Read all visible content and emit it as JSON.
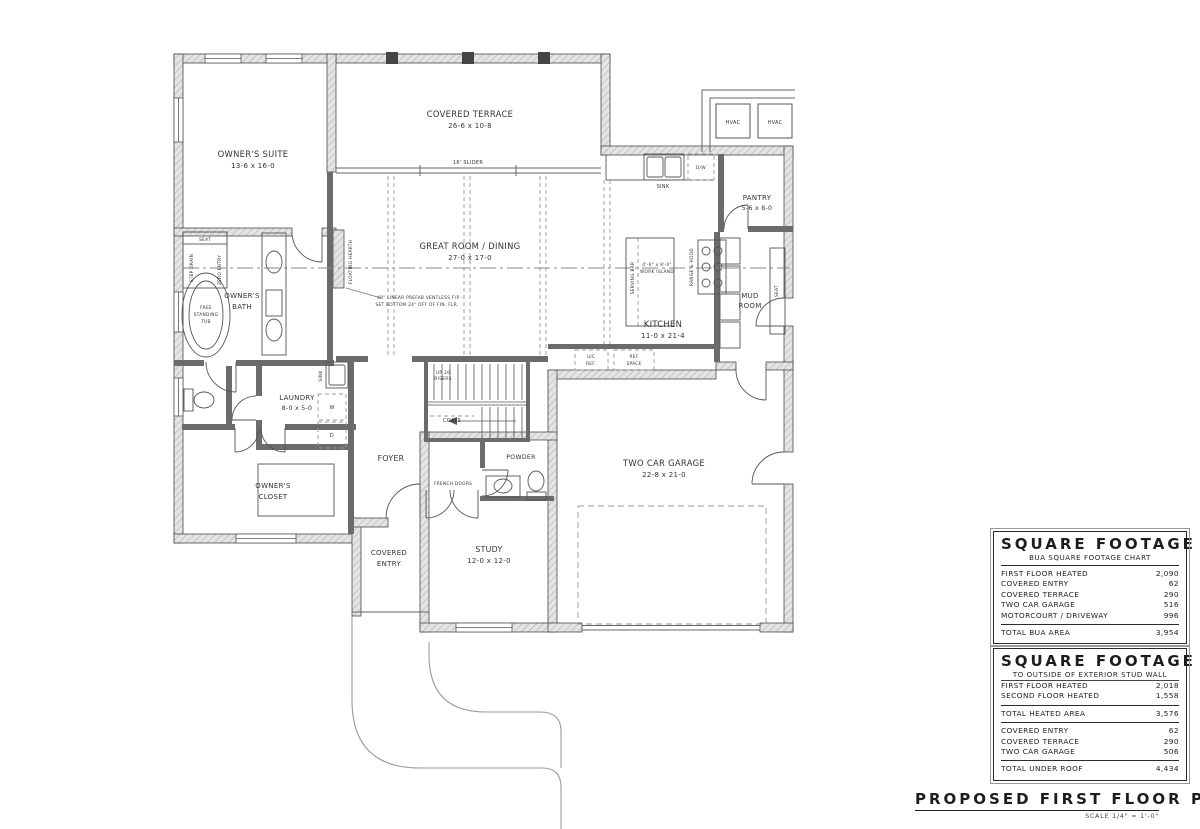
{
  "colors": {
    "ink": "#333333",
    "wall_fill": "#e4e4e4",
    "dashed": "#999999"
  },
  "labels": {
    "owners_suite_name": "OWNER'S SUITE",
    "owners_suite_dims": "13-6 x 16-0",
    "covered_terrace_name": "COVERED TERRACE",
    "covered_terrace_dims": "26-6 x 10-8",
    "slider": "16' SLIDER",
    "great_room_name": "GREAT ROOM / DINING",
    "great_room_dims": "27-0 x 17-0",
    "fp_note_1": "48\" LINEAR PREFAB VENTLESS F/P -",
    "fp_note_2": "SET BOTTOM 24\" OFF OF FIN. FLR.",
    "floating_hearth": "FLOATING HEARTH",
    "kitchen_name": "KITCHEN",
    "kitchen_dims": "11-0 x 21-4",
    "serving_bar": "SERVING BAR",
    "island_dims": "4'-0\" x 9'-0\"",
    "island_name": "WORK ISLAND",
    "range_hood": "RANGE & HOOD",
    "sink_kitchen": "SINK",
    "dw": "D/W",
    "pantry_name": "PANTRY",
    "pantry_dims": "5-6 x 8-0",
    "mud_room_1": "MUD",
    "mud_room_2": "ROOM",
    "seat_mud": "SEAT",
    "owners_bath_1": "OWNER'S",
    "owners_bath_2": "BATH",
    "tub_1": "FREE",
    "tub_2": "STANDING",
    "tub_3": "TUB",
    "seat_shower": "SEAT",
    "step_drain": "STEP DRAIN",
    "zero_entry": "ZERO ENTRY",
    "laundry_name": "LAUNDRY",
    "laundry_dims": "8-0 x 5-0",
    "sink_laundry": "SINK",
    "washer": "W",
    "dryer": "D",
    "foyer": "FOYER",
    "coats": "COATS",
    "up_1": "UP 20",
    "up_2": "RISERS",
    "powder": "POWDER",
    "french_doors": "FRENCH DOORS",
    "study_name": "STUDY",
    "study_dims": "12-0 x 12-0",
    "covered_entry_1": "COVERED",
    "covered_entry_2": "ENTRY",
    "owners_closet_1": "OWNER'S",
    "owners_closet_2": "CLOSET",
    "garage_name": "TWO CAR GARAGE",
    "garage_dims": "22-8 x 21-0",
    "hvac": "HVAC",
    "uc_ref_1": "U/C",
    "uc_ref_2": "REF.",
    "ref_space_1": "REF",
    "ref_space_2": "SPACE"
  },
  "tables": {
    "bua": {
      "title": "SQUARE FOOTAGE",
      "subtitle": "BUA SQUARE FOOTAGE CHART",
      "rows": [
        {
          "label": "FIRST FLOOR HEATED",
          "value": "2,090"
        },
        {
          "label": "COVERED ENTRY",
          "value": "62"
        },
        {
          "label": "COVERED TERRACE",
          "value": "290"
        },
        {
          "label": "TWO CAR GARAGE",
          "value": "516"
        },
        {
          "label": "MOTORCOURT / DRIVEWAY",
          "value": "996"
        }
      ],
      "total": {
        "label": "TOTAL BUA AREA",
        "value": "3,954"
      }
    },
    "stud": {
      "title": "SQUARE FOOTAGE",
      "subtitle": "TO OUTSIDE OF EXTERIOR STUD WALL",
      "heated_rows": [
        {
          "label": "FIRST FLOOR HEATED",
          "value": "2,018"
        },
        {
          "label": "SECOND FLOOR HEATED",
          "value": "1,558"
        }
      ],
      "total_heated": {
        "label": "TOTAL HEATED AREA",
        "value": "3,576"
      },
      "roof_rows": [
        {
          "label": "COVERED ENTRY",
          "value": "62"
        },
        {
          "label": "COVERED TERRACE",
          "value": "290"
        },
        {
          "label": "TWO CAR GARAGE",
          "value": "506"
        }
      ],
      "total_roof": {
        "label": "TOTAL UNDER ROOF",
        "value": "4,434"
      }
    }
  },
  "title_block": {
    "title": "PROPOSED FIRST FLOOR PLAN",
    "scale": "SCALE 1/4\" = 1'-0\""
  }
}
